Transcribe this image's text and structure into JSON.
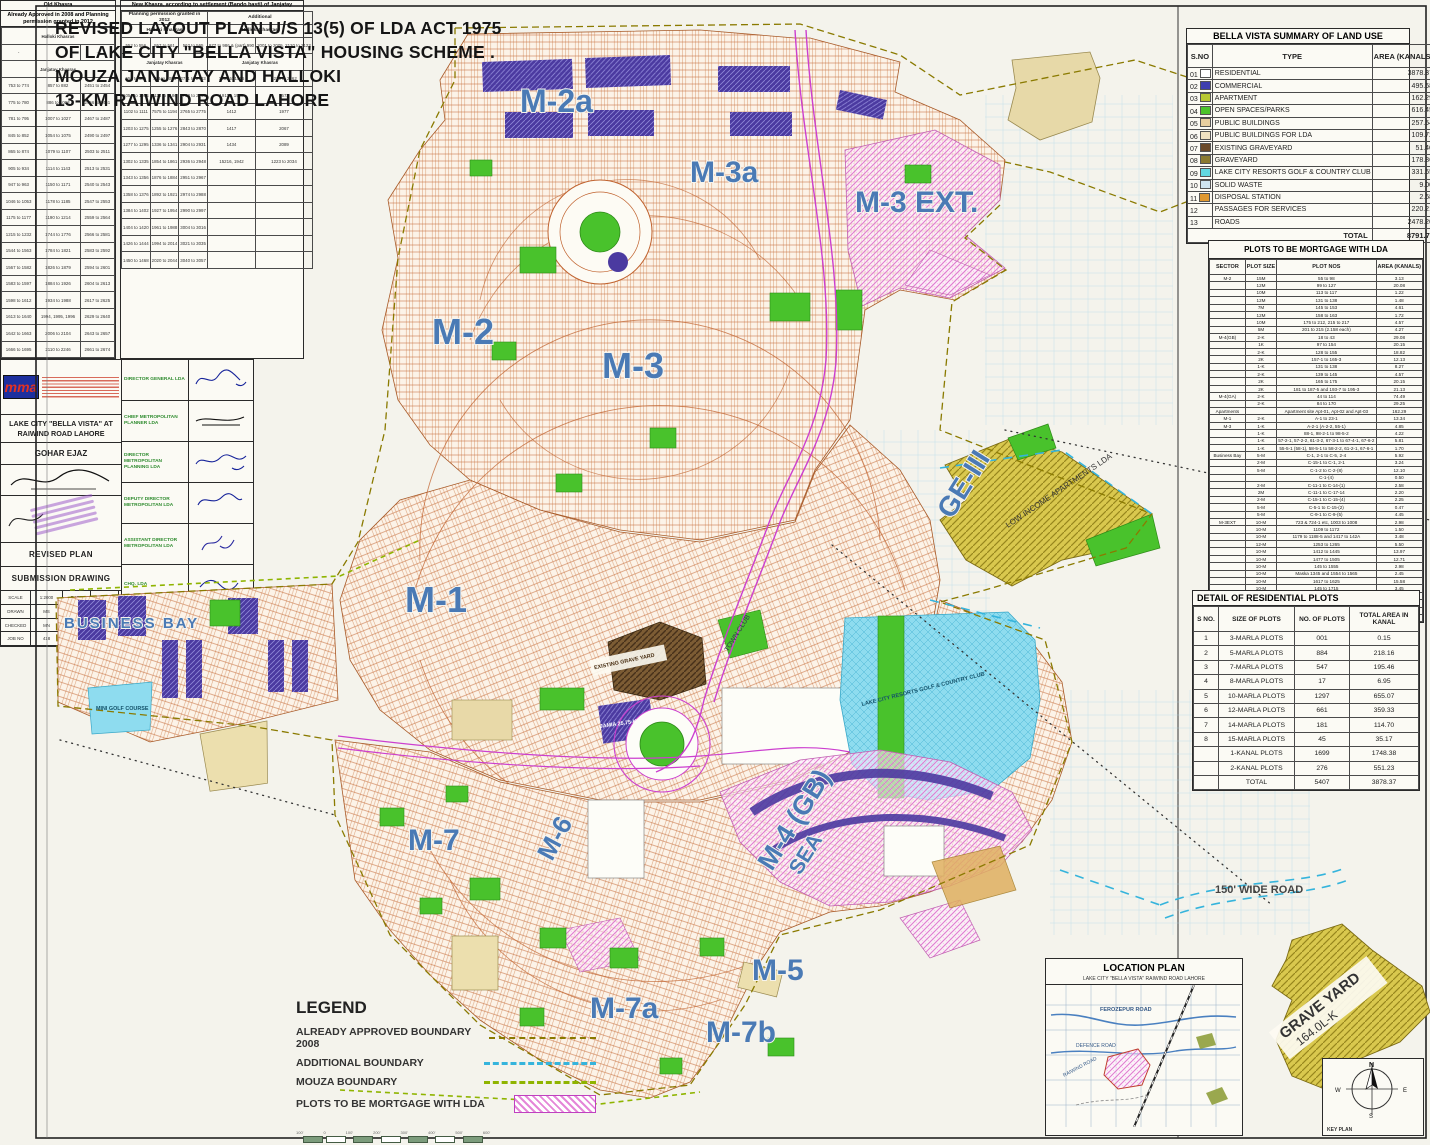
{
  "header": {
    "lines": [
      "REVISED LAYOUT PLAN U/S 13(5) OF LDA ACT 1975",
      "OF LAKE CITY \"BELLA VISTA\"  HOUSING SCHEME .",
      "MOUZA JANJATAY AND HALLOKI",
      "13-KM RAIWIND ROAD LAHORE"
    ]
  },
  "landuse": {
    "title": "BELLA VISTA  SUMMARY OF LAND USE",
    "headers": [
      "S.NO",
      "TYPE",
      "AREA (KANALS)",
      "% age"
    ],
    "rows": [
      {
        "no": "01",
        "type": "RESIDENTIAL",
        "area": "3878.37",
        "pct": "44.11 %",
        "color": "#ffffff"
      },
      {
        "no": "02",
        "type": "COMMERCIAL",
        "area": "495.68",
        "pct": "5.64 %",
        "color": "#3f3fae"
      },
      {
        "no": "03",
        "type": "APARTMENT",
        "area": "162.29",
        "pct": "1.85 %",
        "color": "#b8c832"
      },
      {
        "no": "04",
        "type": "OPEN SPACES/PARKS",
        "area": "616.45",
        "pct": "7.00 %",
        "color": "#4cc42c"
      },
      {
        "no": "05",
        "type": "PUBLIC BUILDINGS",
        "area": "257.54",
        "pct": "2.93 %",
        "color": "#e8cfa0"
      },
      {
        "no": "06",
        "type": "PUBLIC BUILDINGS FOR LDA",
        "area": "109.72",
        "pct": "1.25 %",
        "color": "#f0e2c2"
      },
      {
        "no": "07",
        "type": "EXISTING GRAVEYARD",
        "area": "51.46",
        "pct": "0.59 %",
        "color": "#6b4a2a"
      },
      {
        "no": "08",
        "type": "GRAVEYARD",
        "area": "178.86",
        "pct": "2.03 %",
        "color": "#8a7a30"
      },
      {
        "no": "09",
        "type": "LAKE CITY RESORTS GOLF & COUNTRY CLUB",
        "area": "331.65",
        "pct": "3.77 %",
        "color": "#62d8e0"
      },
      {
        "no": "10",
        "type": "SOLID WASTE",
        "area": "9.00",
        "pct": "0.10 %",
        "color": "#cfe4f0"
      },
      {
        "no": "11",
        "type": "DISPOSAL STATION",
        "area": "2.68",
        "pct": "0.03 %",
        "color": "#e09830"
      },
      {
        "no": "12",
        "type": "PASSAGES FOR SERVICES",
        "area": "220.21",
        "pct": "2.60 %",
        "color": null
      },
      {
        "no": "13",
        "type": "ROADS",
        "area": "2478.20",
        "pct": "28.20 %",
        "color": null
      }
    ],
    "total_label": "TOTAL",
    "total_area": "8791.73",
    "total_pct": "100.00 %"
  },
  "mortgage": {
    "title": "PLOTS TO BE MORTGAGE WITH LDA",
    "headers": [
      "SECTOR",
      "PLOT SIZE",
      "PLOT NOS",
      "AREA (KANALS)"
    ],
    "rows": [
      [
        "M-2",
        "15M",
        "55 to 98",
        "3.13"
      ],
      [
        "",
        "12M",
        "99 to 127",
        "20.08"
      ],
      [
        "",
        "10M",
        "113 to 117",
        "1.22"
      ],
      [
        "",
        "12M",
        "131 to 138",
        "1.48"
      ],
      [
        "",
        "7M",
        "145 to 153",
        "4.61"
      ],
      [
        "",
        "12M",
        "158 to 163",
        "1.72"
      ],
      [
        "",
        "10M",
        "175 to 212, 215 to 217",
        "4.57"
      ],
      [
        "",
        "5M",
        "201 to 215 (2.158 each)",
        "4.27"
      ],
      [
        "M-4(GB)",
        "2-K",
        "18 to 43",
        "29.08"
      ],
      [
        "",
        "1K",
        "97 to 154",
        "20.15"
      ],
      [
        "",
        "2-K",
        "128 to 155",
        "18.82"
      ],
      [
        "",
        "2K",
        "157-1 to 165-3",
        "12.13"
      ],
      [
        "",
        "1-K",
        "131 to 138",
        "8.27"
      ],
      [
        "",
        "2-K",
        "139 to 145",
        "4.57"
      ],
      [
        "",
        "2K",
        "165 to 175",
        "20.15"
      ],
      [
        "",
        "2K",
        "181 to 187-5 and 193-7 to 195-3",
        "21.13"
      ],
      [
        "M-4(GA)",
        "2-K",
        "44 to 114",
        "74.49"
      ],
      [
        "",
        "2-K",
        "84 to 170",
        "29.25"
      ],
      [
        "Apartments",
        "",
        "Apartment site Apt-01, Apt-02 and Apt-03",
        "162.29"
      ],
      [
        "M-1",
        "2-K",
        "A-1 to 23-1",
        "13.34"
      ],
      [
        "M-3",
        "1-K",
        "A-2-1 (A-2-2, 55-1)",
        "4.85"
      ],
      [
        "",
        "1-K",
        "88-1, 98-2-1 to 98-5-2",
        "4.22"
      ],
      [
        "",
        "1-K",
        "57-2-1, 57-2-2, 61-3-2, 67-3-1 to 67-4-1, 67-6-2",
        "5.81"
      ],
      [
        "",
        "1-K",
        "55-5-1 (58-1), 58-5-1 to 58-2-2, 61-2-1, 67-6-1",
        "1.70"
      ],
      [
        "Business Bay",
        "5-M",
        "C-1, 2-1 to C-5, 2-4",
        "5.92"
      ],
      [
        "",
        "2-M",
        "C-15-1 to C-1, 2-1",
        "3.24"
      ],
      [
        "",
        "5-M",
        "C-1-2 to C-2-(8)",
        "12.10"
      ],
      [
        "",
        "",
        "C-1-(4)",
        "0.50"
      ],
      [
        "",
        "2-M",
        "C-11-1 to C-14-(1)",
        "2.58"
      ],
      [
        "",
        "2M",
        "C-11-1 to C-17-14",
        "2.20"
      ],
      [
        "",
        "2-M",
        "C-15-1 to C-15-(4)",
        "2.25"
      ],
      [
        "",
        "5-M",
        "C-5-1 to C-15-(2)",
        "0.47"
      ],
      [
        "",
        "5-M",
        "C-9-1 to C-9-(5)",
        "4.45"
      ],
      [
        "M-3EXT",
        "10-M",
        "723 & 724-1 etc, 1003 to 1008",
        "2.98"
      ],
      [
        "",
        "10-M",
        "1109 to 1172",
        "1.50"
      ],
      [
        "",
        "10-M",
        "1179 to 1188-5 and 1417 to 142A",
        "3.48"
      ],
      [
        "",
        "12-M",
        "1253 to 1265",
        "5.50"
      ],
      [
        "",
        "10-M",
        "1412 to 1445",
        "13.97"
      ],
      [
        "",
        "10-M",
        "1477 to 1505",
        "12.71"
      ],
      [
        "",
        "10-M",
        "145 to 1555",
        "2.98"
      ],
      [
        "",
        "10-M",
        "Maska 1345 and 1554 to 1565",
        "2.45"
      ],
      [
        "",
        "10-M",
        "1617 to 1625",
        "15.58"
      ],
      [
        "",
        "10-M",
        "145 to 1715",
        "3.45"
      ],
      [
        "",
        "10-M",
        "1732 to 1737 and 1740 to 1746",
        "6.29"
      ],
      [
        "M-2a",
        "2-K",
        "C-42-1 to C-42-10",
        "50.30"
      ],
      [
        "",
        "1-K",
        "C-46-11 to C-2-1298",
        "16.92"
      ],
      [
        "",
        "",
        "Total",
        "738.15"
      ]
    ]
  },
  "residential": {
    "title": "DETAIL OF RESIDENTIAL PLOTS",
    "headers": [
      "S NO.",
      "SIZE OF PLOTS",
      "NO. OF PLOTS",
      "TOTAL AREA IN KANAL"
    ],
    "rows": [
      [
        "1",
        "3-MARLA PLOTS",
        "001",
        "0.15"
      ],
      [
        "2",
        "5-MARLA PLOTS",
        "884",
        "218.16"
      ],
      [
        "3",
        "7-MARLA PLOTS",
        "547",
        "195.46"
      ],
      [
        "4",
        "8-MARLA PLOTS",
        "17",
        "6.95"
      ],
      [
        "5",
        "10-MARLA PLOTS",
        "1297",
        "655.07"
      ],
      [
        "6",
        "12-MARLA PLOTS",
        "661",
        "359.33"
      ],
      [
        "7",
        "14-MARLA PLOTS",
        "181",
        "114.70"
      ],
      [
        "8",
        "15-MARLA PLOTS",
        "45",
        "35.17"
      ],
      [
        "",
        "1-KANAL PLOTS",
        "1699",
        "1748.38"
      ],
      [
        "",
        "2-KANAL PLOTS",
        "276",
        "551.23"
      ],
      [
        "",
        "TOTAL",
        "5407",
        "3878.37"
      ]
    ]
  },
  "khasra": {
    "old": {
      "title": "Old Khasra",
      "subtitle": "Already Approved in 2008 and Planning permission granted in 2012",
      "halloki_label": "Halloki Khasras",
      "halloki_row": [
        "-",
        "-",
        "-"
      ],
      "janjatay_label": "Janjatay Khasras",
      "rows": [
        [
          "753 to 774",
          "857 to 882",
          "2451 to 2454"
        ],
        [
          "775 to 780",
          "886 to 1003",
          "2456 to 2461"
        ],
        [
          "781 to 795",
          "1007 to 1027",
          "2467 to 2487"
        ],
        [
          "845 to 852",
          "1054 to 1075",
          "2490 to 2497"
        ],
        [
          "865 to 874",
          "1079 to 1107",
          "2503 to 2511"
        ],
        [
          "905 to 934",
          "1114 to 1143",
          "2513 to 2531"
        ],
        [
          "947 to 963",
          "1150 to 1171",
          "2540 to 2543"
        ],
        [
          "1046 to 1053",
          "1178 to 1185",
          "2547 to 2553"
        ],
        [
          "1175 to 1177",
          "1190 to 1214",
          "2559 to 2564"
        ],
        [
          "1215 to 1232",
          "1744 to 1776",
          "2566 to 2581"
        ],
        [
          "1544 to 1563",
          "1784 to 1821",
          "2583 to 2592"
        ],
        [
          "1567 to 1582",
          "1826 to 1879",
          "2594 to 2601"
        ],
        [
          "1583 to 1597",
          "1884 to 1926",
          "2604 to 2613"
        ],
        [
          "1598 to 1612",
          "1934 to 1988",
          "2617 to 2625"
        ],
        [
          "1613 to 1640",
          "1994, 1995, 1996",
          "2629 to 2640"
        ],
        [
          "1642 to 1663",
          "2006 to 2104",
          "2643 to 2657"
        ],
        [
          "1666 to 1695",
          "2110 to 2246",
          "2661 to 2674"
        ]
      ]
    },
    "new": {
      "title": "New Khasra, according to settlement (Bando basti) of Janjatay",
      "col1_label": "Planning permission granted in 2012",
      "col2_label": "Additional",
      "halloki_label": "Halloki Khasras",
      "halloki_row": [
        "552 to 556",
        "557 to 561",
        "562 to 565",
        "977 to 986 & (part) 990",
        "2001 to 2005, 2120 to 2122"
      ],
      "janjatay_label": "Janjatay Khasras",
      "rows": [
        [
          "556 to 585",
          "753 to 1003",
          "2711 to 2733",
          "1551 to 1566",
          "2239 to 2262"
        ],
        [
          "1054 to 1094",
          "1114 to 1186",
          "2750 to 2763",
          "19116, 1942",
          "2672"
        ],
        [
          "1102 to 1111",
          "7575 to 1194",
          "2765 to 2775",
          "1412",
          "1977"
        ],
        [
          "1203 to 1275",
          "1255 to 1276",
          "2843 to 2870",
          "1417",
          "2067"
        ],
        [
          "1277 to 1295",
          "1336 to 1341",
          "2904 to 2931",
          "1434",
          "2089"
        ],
        [
          "1302 to 1335",
          "1854 to 1861",
          "2936 to 2948",
          "15216, 1942",
          "1223 to 2034"
        ],
        [
          "1343 to 1356",
          "1876 to 1884",
          "2951 to 2967",
          "",
          ""
        ],
        [
          "1358 to 1376",
          "1892 to 1921",
          "2974 to 2988",
          "",
          ""
        ],
        [
          "1384 to 1402",
          "1927 to 1954",
          "2990 to 2997",
          "",
          ""
        ],
        [
          "1404 to 1420",
          "1961 to 1988",
          "3004 to 3016",
          "",
          ""
        ],
        [
          "1426 to 1444",
          "1994 to 2014",
          "3021 to 3035",
          "",
          ""
        ],
        [
          "1450 to 1468",
          "2020 to 2044",
          "3040 to 3057",
          "",
          ""
        ]
      ]
    }
  },
  "legend": {
    "title": "LEGEND",
    "items": [
      {
        "label": "ALREADY APPROVED BOUNDARY 2008",
        "type": "dash-olive"
      },
      {
        "label": "ADDITIONAL BOUNDARY",
        "type": "dash-cyan"
      },
      {
        "label": "MOUZA BOUNDARY",
        "type": "dash-green"
      },
      {
        "label": "PLOTS TO BE MORTGAGE WITH LDA",
        "type": "pink-hatch"
      }
    ],
    "scale_ticks": [
      "100'",
      "0",
      "100'",
      "200'",
      "300'",
      "400'",
      "500'",
      "600'"
    ]
  },
  "titleblock": {
    "firm_logo": "mma",
    "project": "LAKE CITY \"BELLA VISTA\" AT RAIWIND ROAD LAHORE",
    "designer": "GOHAR EJAZ",
    "plan_title": "REVISED PLAN",
    "drawing_type": "SUBMISSION DRAWING",
    "grid": [
      "SCALE",
      "1:2000",
      "DATE",
      "04-10-2013",
      "DRAWN",
      "MS",
      "DESIGN",
      "GE",
      "CHECKED",
      "MN",
      "APPROVED",
      "MN",
      "JOB NO",
      "418",
      "DRAWING NO",
      "MP-152"
    ],
    "officials": [
      "DIRECTOR GENERAL LDA",
      "CHIEF METROPOLITAN PLANNER LDA",
      "DIRECTOR METROPOLITAN PLANNING LDA",
      "DEPUTY DIRECTOR METROPOLITAN LDA",
      "ASSISTANT DIRECTOR METROPOLITAN LDA",
      "CHQ. LDA",
      "PATWARI / DRAWING"
    ]
  },
  "location": {
    "title": "LOCATION PLAN",
    "subtitle": "LAKE CITY \"BELLA VISTA\" RAIWIND ROAD LAHORE",
    "road1": "FEROZEPUR ROAD",
    "road2": "DEFENCE ROAD",
    "road3": "RAIWIND ROAD"
  },
  "keyplan": {
    "caption": "KEY PLAN",
    "n": "N",
    "e": "E",
    "s": "S",
    "w": "W"
  },
  "map": {
    "labels": {
      "m2a": "M-2a",
      "m3a": "M-3a",
      "m3ext": "M-3 EXT.",
      "m2": "M-2",
      "m3": "M-3",
      "m1": "M-1",
      "ge3": "GE-III",
      "m7": "M-7",
      "m6": "M-6",
      "m4gb": "M-4 (GB)",
      "sea": "SEA",
      "m5": "M-5",
      "m7a": "M-7a",
      "m7b": "M-7b",
      "business_bay": "BUSINESS BAY",
      "road150": "150' WIDE ROAD",
      "grave_yard": "GRAVE YARD",
      "grave_yard_area": "164.0L-K",
      "low_income": "LOW INCOME APARTMENTS LDA",
      "existing_graveyard": "EXISTING GRAVE YARD",
      "town_club": "TOWN CLUB",
      "mini_golf": "MINI GOLF COURSE",
      "golf_club": "LAKE CITY RESORTS GOLF & COUNTRY CLUB",
      "jamia": "JAMIA 25.75-K"
    },
    "colors": {
      "label_blue": "#4a7ab5",
      "park_green": "#49c22c",
      "commercial_purple": "#4b3aa0",
      "mortgage_pink": "#df7ad0",
      "olive": "#d9c84e",
      "cyan": "#8edcef",
      "plot_orange": "#c0622e",
      "magenta": "#cc3fcf"
    }
  }
}
